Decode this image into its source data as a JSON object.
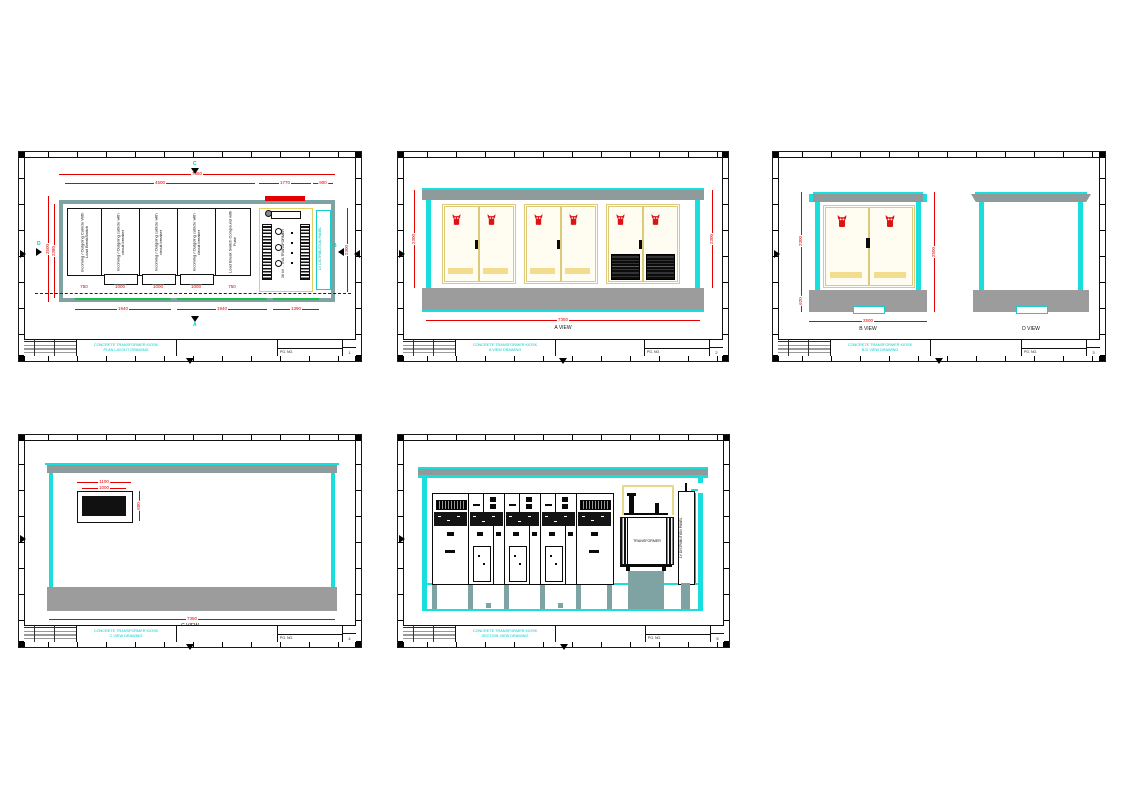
{
  "tb": {
    "pg_label": "PG. NO."
  },
  "plan": {
    "title1": "CONCRETE TRANSFORMER KIOSK",
    "title2": "PLAN LAYOUT DRAWING",
    "pg": "1",
    "markers": {
      "top": "C",
      "bottom": "A",
      "left": "D",
      "right": "B"
    },
    "cubicles": [
      "Incoming / Outgoing Cubicle With Load BreakSwitch",
      "Incoming / Outgoing cubicle with circuit breaker",
      "Incoming / Outgoing cubicle with circuit breaker",
      "Incoming / Outgoing cubicle with circuit breaker",
      "Load Break Switch Compound with Fuse"
    ],
    "transformer": "36 kV ... kVA TRANSFORMER",
    "lv_panel": "LV DISTRIBUTION PANEL",
    "dims": {
      "overall": "7350",
      "switchgear": "4500",
      "transformer": "1770",
      "lv": "900",
      "c1": "750",
      "c2": "1000",
      "c3": "1000",
      "c4": "1000",
      "c5": "750",
      "b1": "1940",
      "b2": "1940",
      "b3": "1390",
      "left_outer": "2500",
      "left_inner": "2380",
      "right": "2300"
    }
  },
  "a_view": {
    "title1": "CONCRETE TRANSFORMER KIOSK",
    "title2": "A VIEW DRAWING",
    "pg": "2",
    "label": "A VIEW",
    "dims": {
      "left": "2300",
      "right": "2300",
      "bottom": "7350"
    }
  },
  "bd_view": {
    "title1": "CONCRETE TRANSFORMER KIOSK",
    "title2": "B-D VIEW DRAWING",
    "pg": "3",
    "b_label": "B VIEW",
    "d_label": "D VIEW",
    "dims": {
      "left": "2300",
      "plinth": "620",
      "right": "2500",
      "bottom": "2500"
    }
  },
  "c_view": {
    "title1": "CONCRETE TRANSFORMER KIOSK",
    "title2": "C VIEW DRAWING",
    "pg": "4",
    "label": "C VIEW",
    "dims": {
      "bottom": "7350",
      "vent_w": "1100",
      "vent_w2": "1000",
      "vent_h": "600"
    }
  },
  "section": {
    "title1": "CONCRETE TRANSFORMER KIOSK",
    "title2": "SECTION VIEW DRAWING",
    "pg": "5",
    "transformer": "TRANSFORMER",
    "lv_panel": "LV DISTRIBUTION PANEL"
  }
}
